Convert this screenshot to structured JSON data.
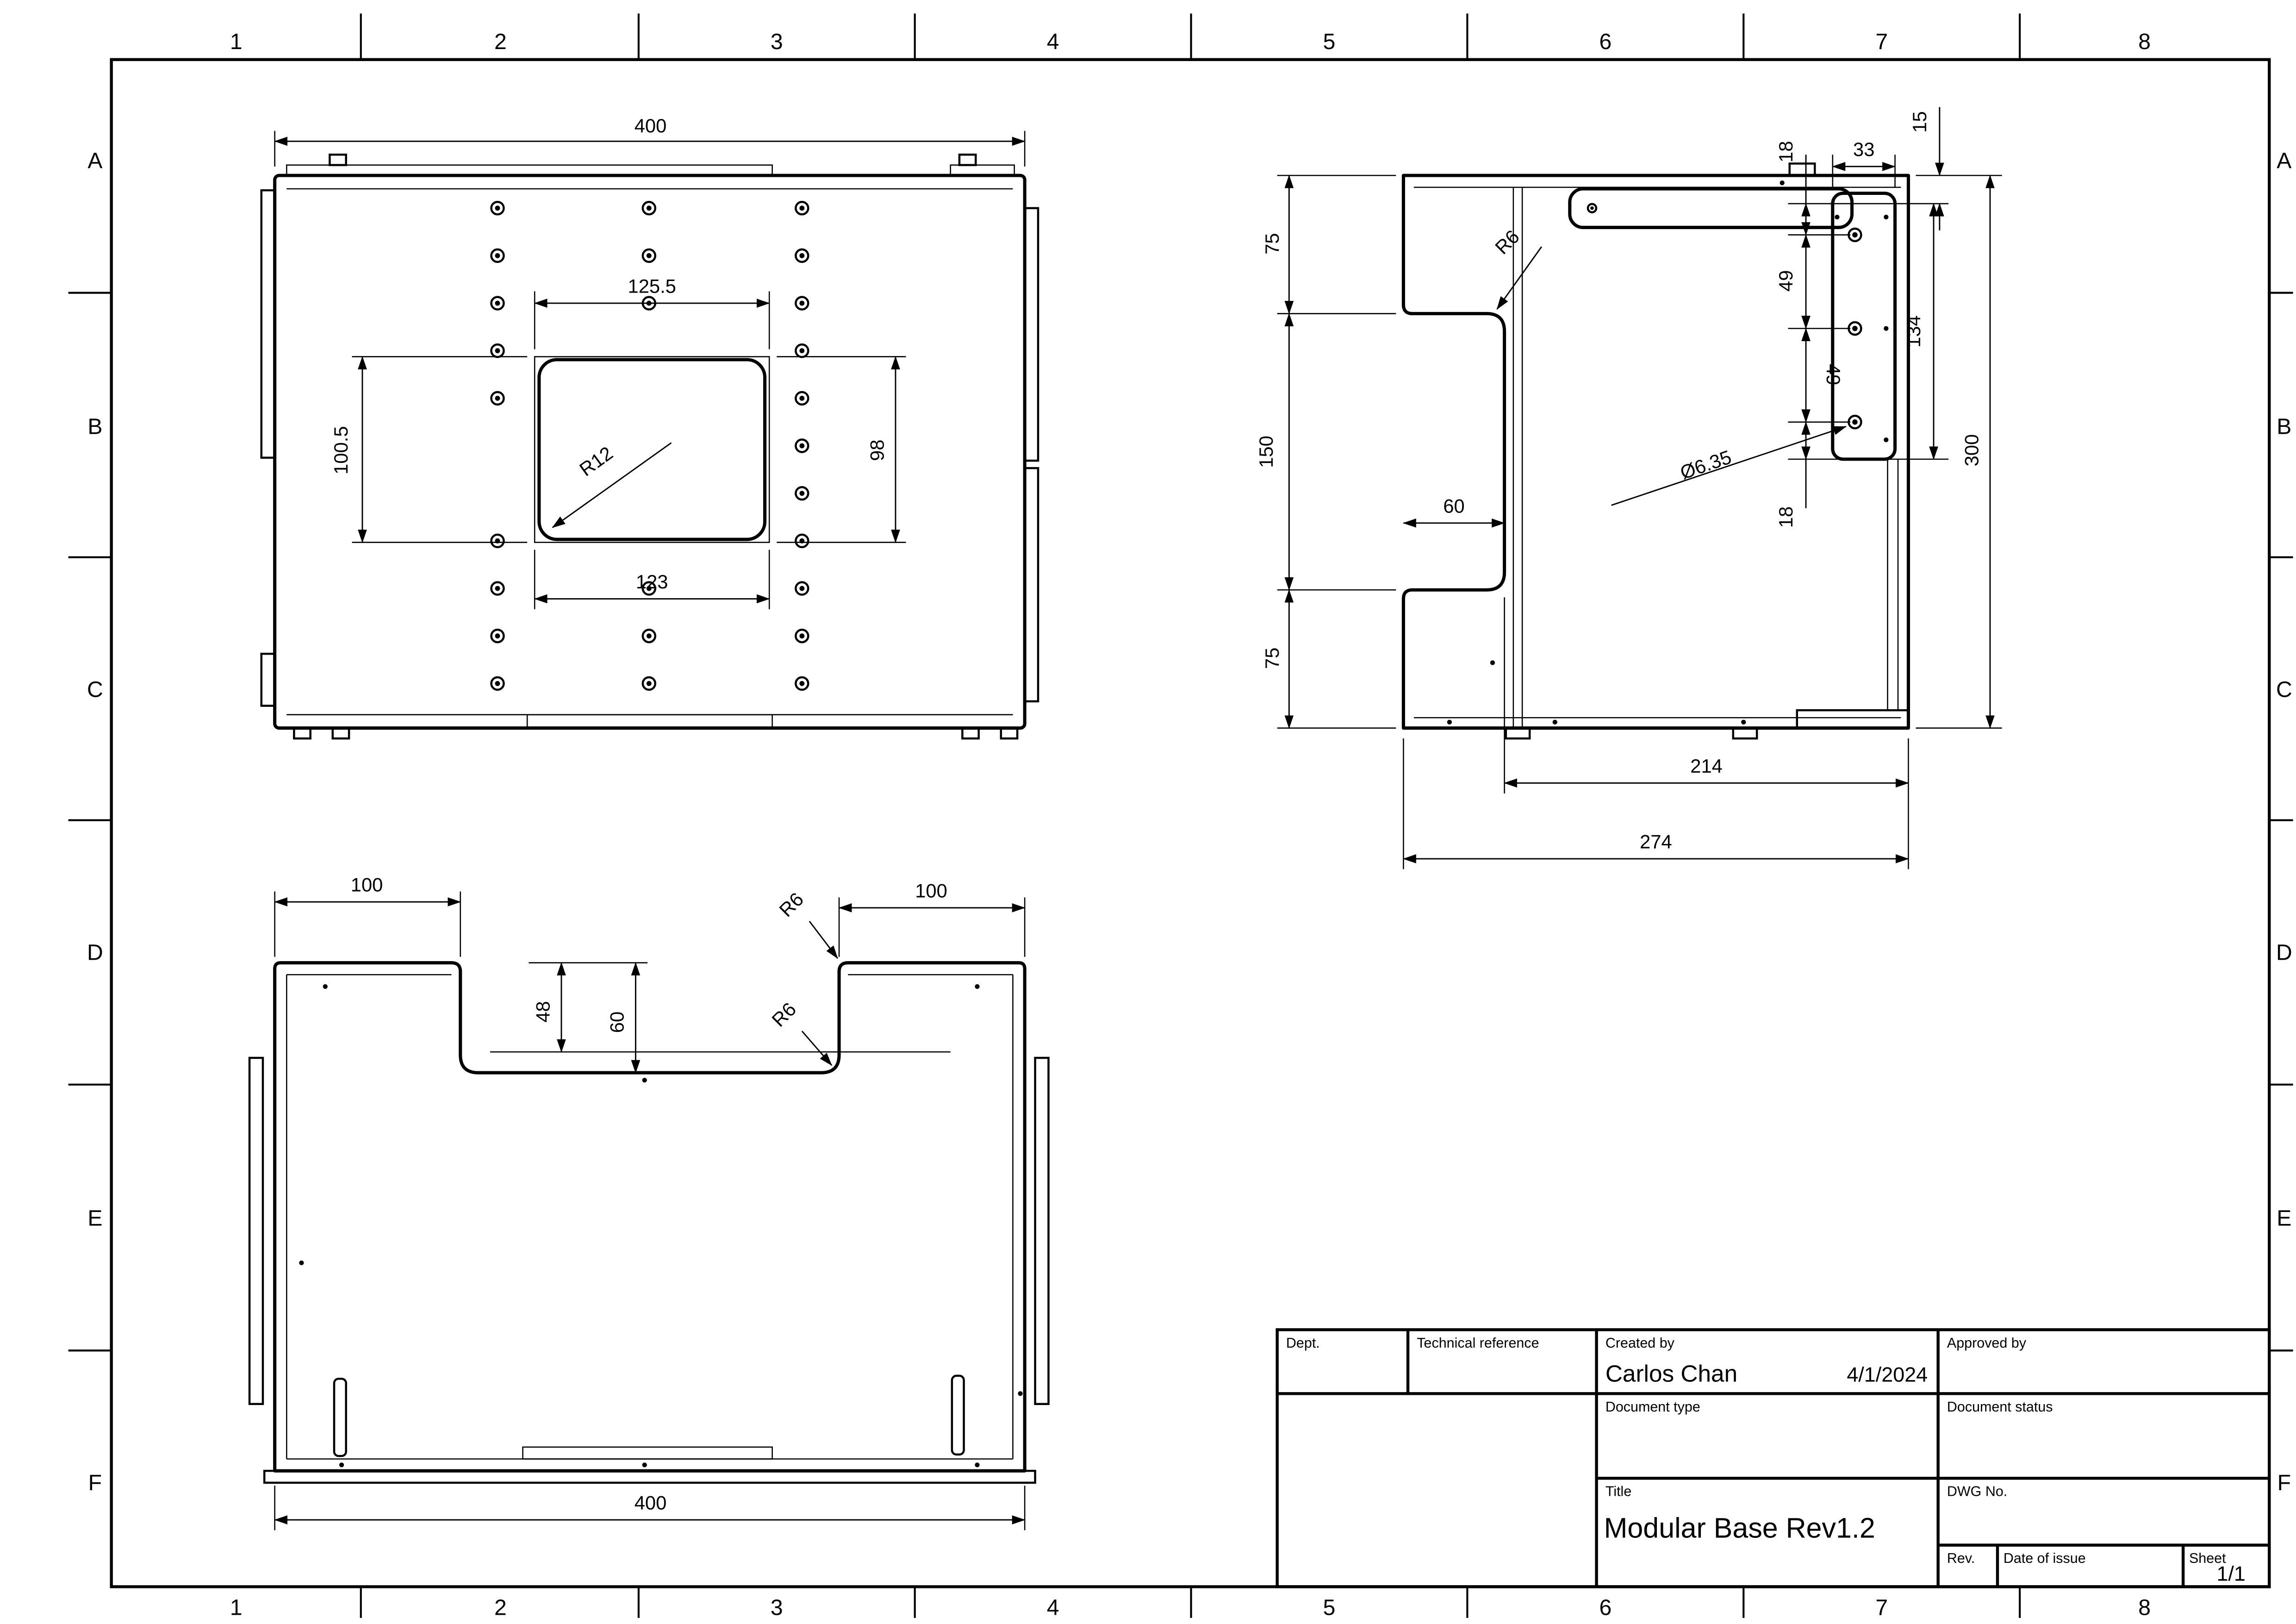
{
  "sheet": {
    "cols": [
      "1",
      "2",
      "3",
      "4",
      "5",
      "6",
      "7",
      "8"
    ],
    "rows": [
      "A",
      "B",
      "C",
      "D",
      "E",
      "F"
    ]
  },
  "title_block": {
    "dept_label": "Dept.",
    "technical_reference_label": "Technical reference",
    "created_by_label": "Created by",
    "created_by_value": "Carlos Chan",
    "created_date": "4/1/2024",
    "approved_by_label": "Approved by",
    "document_type_label": "Document type",
    "document_status_label": "Document status",
    "title_label": "Title",
    "title_value": "Modular Base Rev1.2",
    "dwg_no_label": "DWG No.",
    "rev_label": "Rev.",
    "date_of_issue_label": "Date of issue",
    "sheet_label": "Sheet",
    "sheet_value": "1/1"
  },
  "top_view": {
    "overall_width": "400",
    "cutout_top": "125.5",
    "cutout_bottom": "123",
    "cutout_left": "100.5",
    "cutout_right": "98",
    "radius": "R12"
  },
  "side_view": {
    "seg_top": "75",
    "seg_mid": "150",
    "seg_bottom": "75",
    "notch_depth": "60",
    "fillet": "R6",
    "offset_top": "18",
    "flange_w": "33",
    "plate_offset": "15",
    "pitch1": "49",
    "pitch2": "49",
    "flange_span": "134",
    "height": "300",
    "offset_bottom": "18",
    "hole_dia": "Ø6.35",
    "inner_width": "214",
    "outer_width": "274"
  },
  "front_view": {
    "left_flat": "100",
    "right_flat": "100",
    "step_inner": "48",
    "step_outer": "60",
    "fillet_top": "R6",
    "fillet_bottom": "R6",
    "overall_width": "400"
  }
}
